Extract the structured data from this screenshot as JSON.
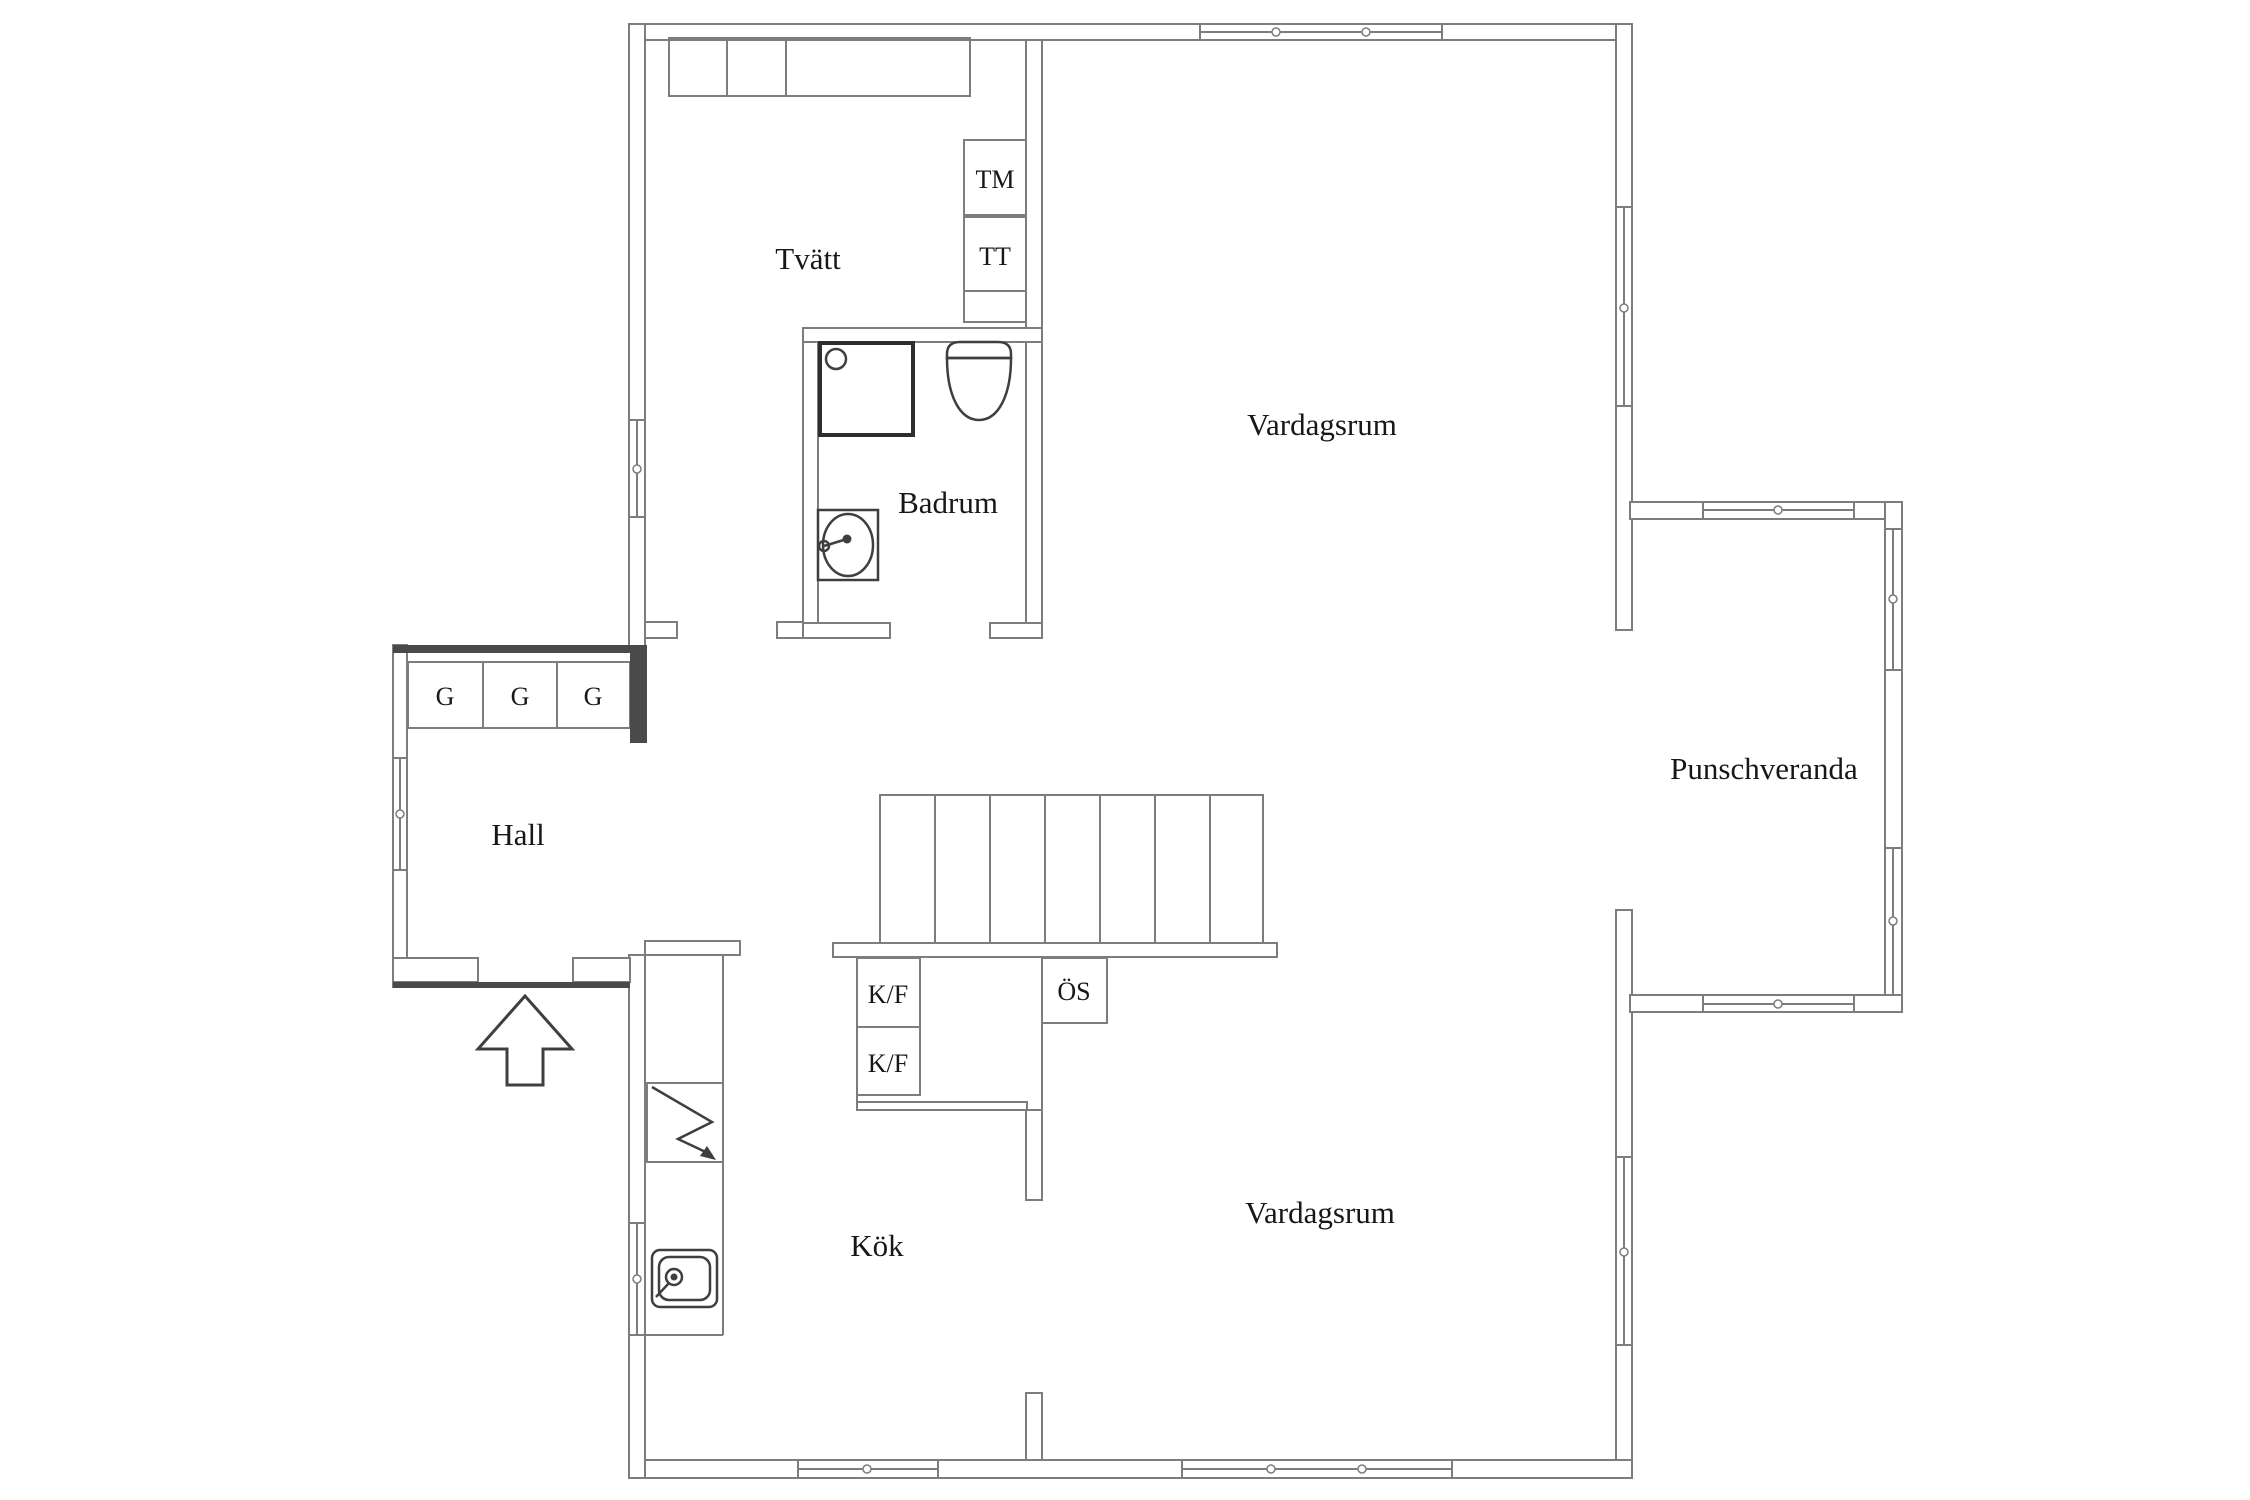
{
  "palette": {
    "background": "#ffffff",
    "wall_line": "#7d7d7d",
    "dark_wall": "#4a4a4a",
    "fixture_line": "#3f3f3f",
    "text": "#171717"
  },
  "rooms": [
    {
      "name": "laundry",
      "label": "Tvätt"
    },
    {
      "name": "bathroom",
      "label": "Badrum"
    },
    {
      "name": "living-room-upper",
      "label": "Vardagsrum"
    },
    {
      "name": "punch-veranda",
      "label": "Punschveranda"
    },
    {
      "name": "hall",
      "label": "Hall"
    },
    {
      "name": "kitchen",
      "label": "Kök"
    },
    {
      "name": "living-room-lower",
      "label": "Vardagsrum"
    }
  ],
  "fixtures": [
    {
      "name": "washing-machine",
      "label": "TM"
    },
    {
      "name": "tumble-dryer",
      "label": "TT"
    },
    {
      "name": "wardrobe-1",
      "label": "G"
    },
    {
      "name": "wardrobe-2",
      "label": "G"
    },
    {
      "name": "wardrobe-3",
      "label": "G"
    },
    {
      "name": "fridge-freezer-1",
      "label": "K/F"
    },
    {
      "name": "fridge-freezer-2",
      "label": "K/F"
    },
    {
      "name": "open-shelf",
      "label": "ÖS"
    }
  ]
}
